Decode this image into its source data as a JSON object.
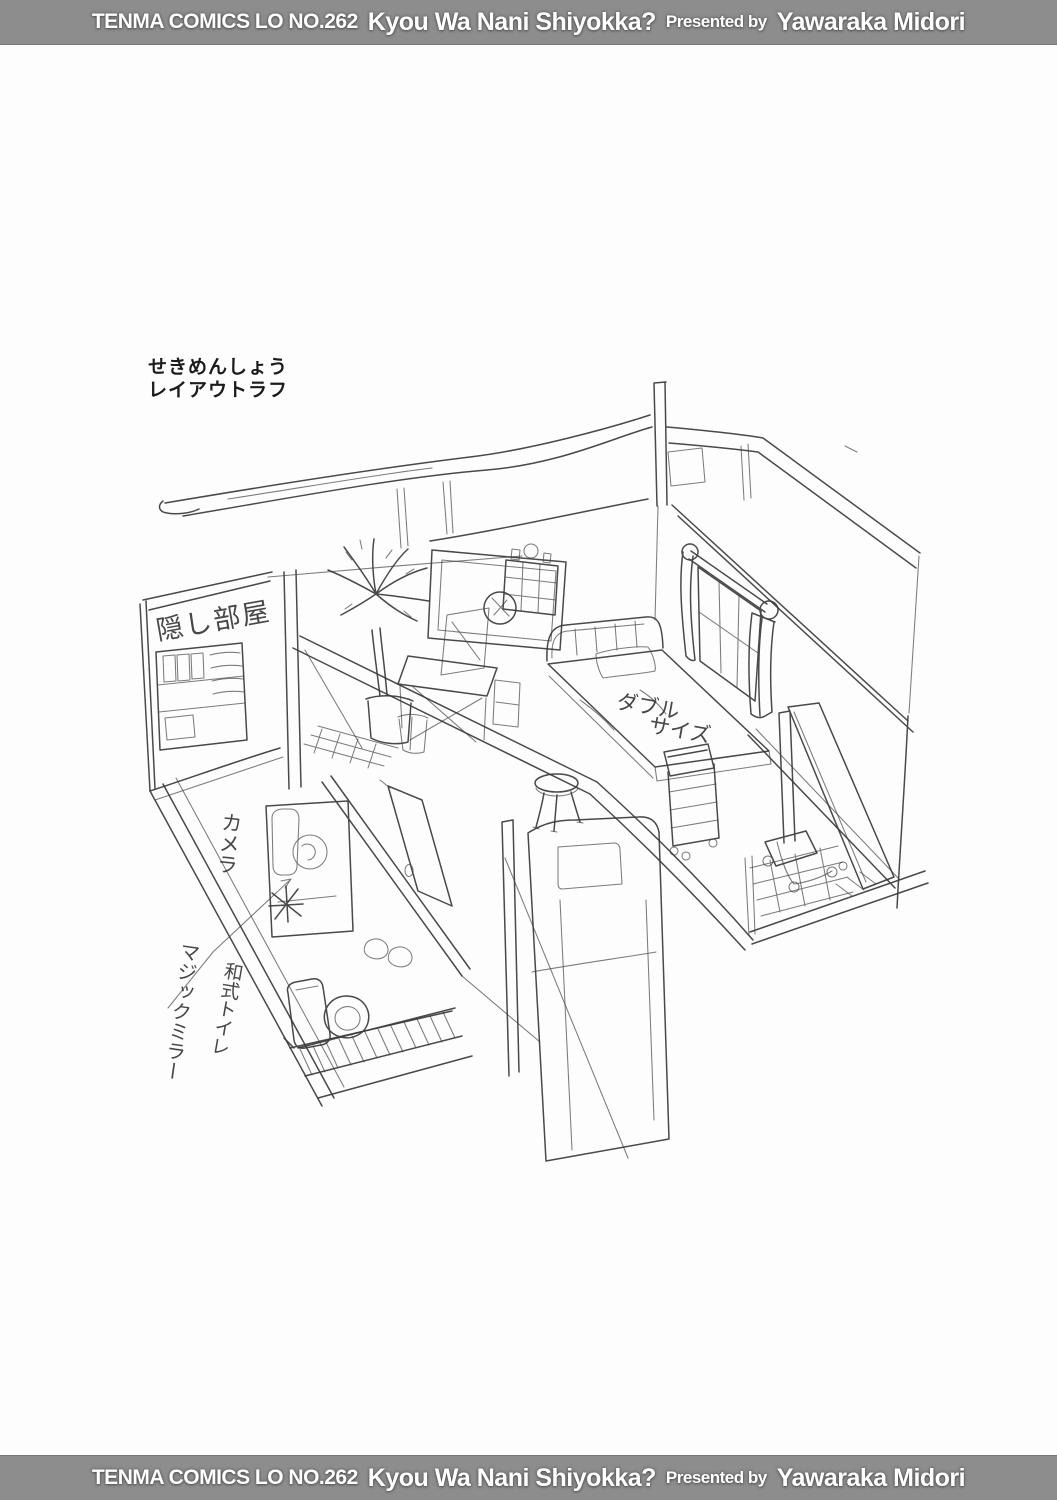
{
  "banner": {
    "series": "TENMA COMICS LO NO.262",
    "title": "Kyou Wa Nani Shiyokka?",
    "presented_by": "Presented by",
    "author": "Yawaraka Midori"
  },
  "caption": {
    "line1": "せきめんしょう",
    "line2": "レイアウトラフ"
  },
  "sketch": {
    "labels": {
      "hidden_room": "隠し部屋",
      "camera": "カメラ",
      "bed_size_line1": "ダブル",
      "bed_size_line2": "サイズ",
      "toilet": "和式トイレ",
      "magic_mirror": "マジックミラー"
    }
  },
  "colors": {
    "banner_bg": "#8d8d8d",
    "banner_text": "#ffffff",
    "pencil": "#3a3a3a",
    "paper": "#fdfdfd"
  }
}
